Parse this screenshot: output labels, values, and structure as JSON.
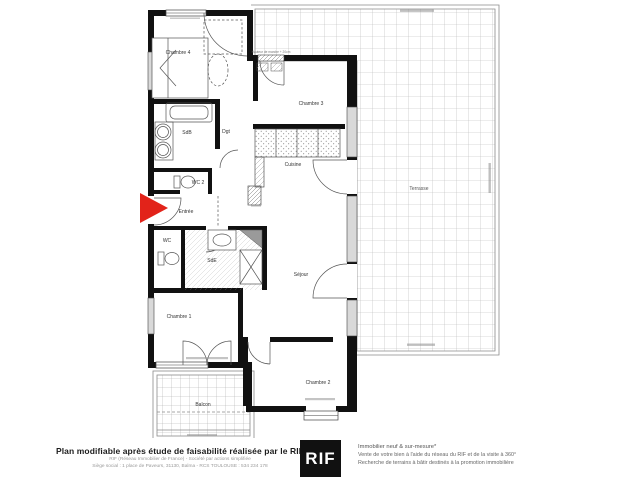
{
  "rooms": {
    "chambre1": "Chambre 1",
    "chambre2": "Chambre 2",
    "chambre3": "Chambre 3",
    "chambre4": "Chambre 4",
    "cuisine": "Cuisine",
    "sejour": "Séjour",
    "entree": "Entrée",
    "sdb": "SdB",
    "sde": "SdE",
    "wc": "WC",
    "wc2": "WC 2",
    "dgt": "Dgt",
    "balcon": "Balcon",
    "terrasse": "Terrasse"
  },
  "annotations": {
    "step_note": "Hauteur de marche + 20cm"
  },
  "colors": {
    "arrow_red": "#e2231a",
    "wall": "#111111",
    "logo_bg": "#111111"
  },
  "footer": {
    "left_bold": "Plan modifiable après étude de faisabilité réalisée par le RIF",
    "left_line2": "RIF (Réseau Immobilier de France) - Société par actions simplifiée",
    "left_line3": "Siège social : 1 place de Paveurs, 31130, Balma - RCS TOULOUSE : 534 234 178",
    "logo_text": "RIF",
    "right_line1": "Immobilier neuf & sur-mesure*",
    "right_line2": "Vente de votre bien à l'aide du réseau du RIF et de la visite à 360°",
    "right_line3": "Recherche de terrains à bâtir destinés à la promotion immobilière"
  }
}
